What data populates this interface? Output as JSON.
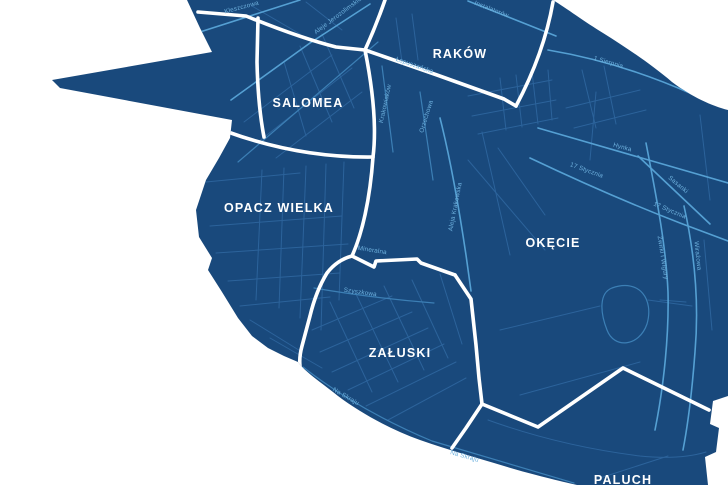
{
  "map": {
    "background_color": "#FFFFFF",
    "land_color": "#19497C",
    "boundary_color": "#FFFFFF",
    "street_color_minor": "#2C639B",
    "street_color_major": "#55A0D3",
    "street_label_color": "#6FB2DF",
    "district_label_color": "#FFFFFF",
    "districts": [
      {
        "name": "RAKÓW"
      },
      {
        "name": "SALOMEA"
      },
      {
        "name": "OPACZ WIELKA"
      },
      {
        "name": "OKĘCIE"
      },
      {
        "name": "ZAŁUSKI"
      },
      {
        "name": "PALUCH"
      }
    ],
    "street_labels": [
      {
        "name": "Kleszczowa"
      },
      {
        "name": "Aleje Jerozolimskie"
      },
      {
        "name": "Instalatorów"
      },
      {
        "name": "Łopuszańska"
      },
      {
        "name": "Krakowiaków"
      },
      {
        "name": "Orzechowa"
      },
      {
        "name": "Aleja Krakowska"
      },
      {
        "name": "1 Sierpnia"
      },
      {
        "name": "Hynka"
      },
      {
        "name": "17 Stycznia"
      },
      {
        "name": "Sasanki"
      },
      {
        "name": "17 Stycznia"
      },
      {
        "name": "Żwirki i Wigury"
      },
      {
        "name": "Wirażowa"
      },
      {
        "name": "Mineralna"
      },
      {
        "name": "Szyszkowa"
      },
      {
        "name": "Na Skraju"
      },
      {
        "name": "Na Skraju"
      }
    ]
  }
}
